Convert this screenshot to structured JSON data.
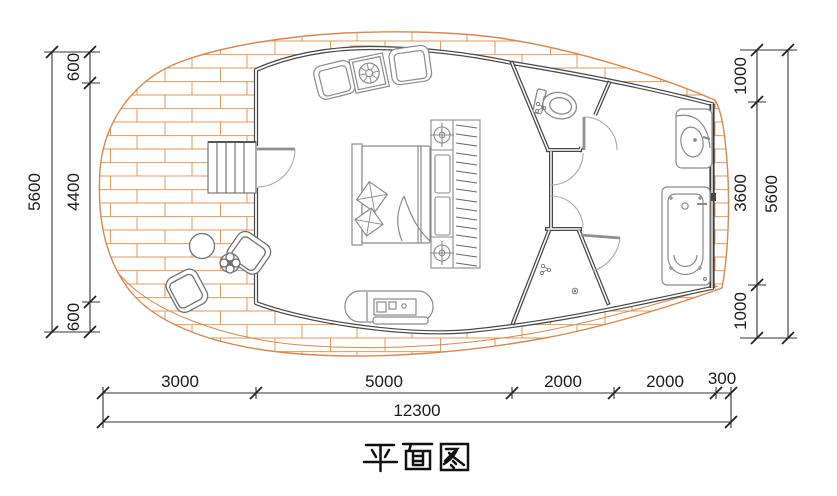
{
  "title": "平面图",
  "dimensions": {
    "left": {
      "total": "5600",
      "segments": [
        "600",
        "4400",
        "600"
      ]
    },
    "right": {
      "total": "5600",
      "segments": [
        "1000",
        "3600",
        "1000"
      ]
    },
    "bottom": {
      "total": "12300",
      "segments": [
        "3000",
        "5000",
        "2000",
        "2000",
        "300"
      ]
    }
  },
  "colors": {
    "deck_plank": "#e2995c",
    "deck_outline": "#d8884e",
    "wall": "#474747",
    "furniture_line": "#8a8a8a",
    "dimension_line": "#2b2b2b",
    "background": "#ffffff"
  },
  "plan_symbols": [
    "stairs",
    "entry-door-swing",
    "outdoor-armchair",
    "outdoor-round-table",
    "potted-plant",
    "lounge-armchair",
    "side-table",
    "double-bed",
    "pillows",
    "wardrobe-with-hangers",
    "downlight",
    "tv-cabinet",
    "toilet",
    "interior-door-swing",
    "shower-door-swing",
    "floor-drain",
    "exhaust-fan",
    "wash-basin",
    "bathtub"
  ]
}
